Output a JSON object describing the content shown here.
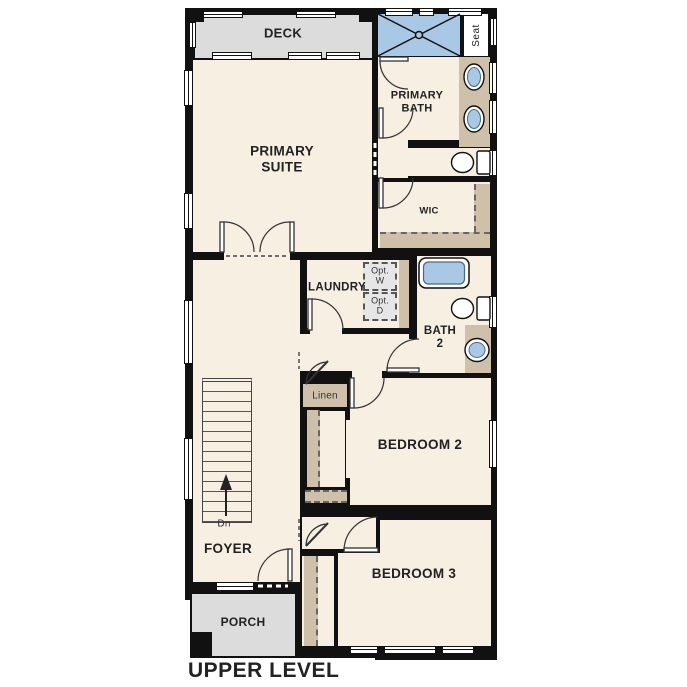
{
  "title": "UPPER LEVEL",
  "rooms": {
    "deck": "DECK",
    "primary_suite": [
      "PRIMARY",
      "SUITE"
    ],
    "primary_bath": [
      "PRIMARY",
      "BATH"
    ],
    "wic": "WIC",
    "laundry": "LAUNDRY",
    "bath2": [
      "BATH",
      "2"
    ],
    "bedroom2": "BEDROOM 2",
    "bedroom3": "BEDROOM 3",
    "foyer": "FOYER",
    "porch": "PORCH"
  },
  "fixtures": {
    "shower_seat": "Seat",
    "opt_washer": [
      "Opt.",
      "W"
    ],
    "opt_dryer": [
      "Opt.",
      "D"
    ],
    "linen": "Linen"
  },
  "stairs": {
    "direction": "Dn"
  },
  "colors": {
    "wall": "#111111",
    "floor": "#f7efe2",
    "outdoor": "#dcdcdc",
    "casework": "#cfc1a9",
    "water_fixture": "#a9c8e6",
    "optional_fill": "#e6e6e6"
  }
}
